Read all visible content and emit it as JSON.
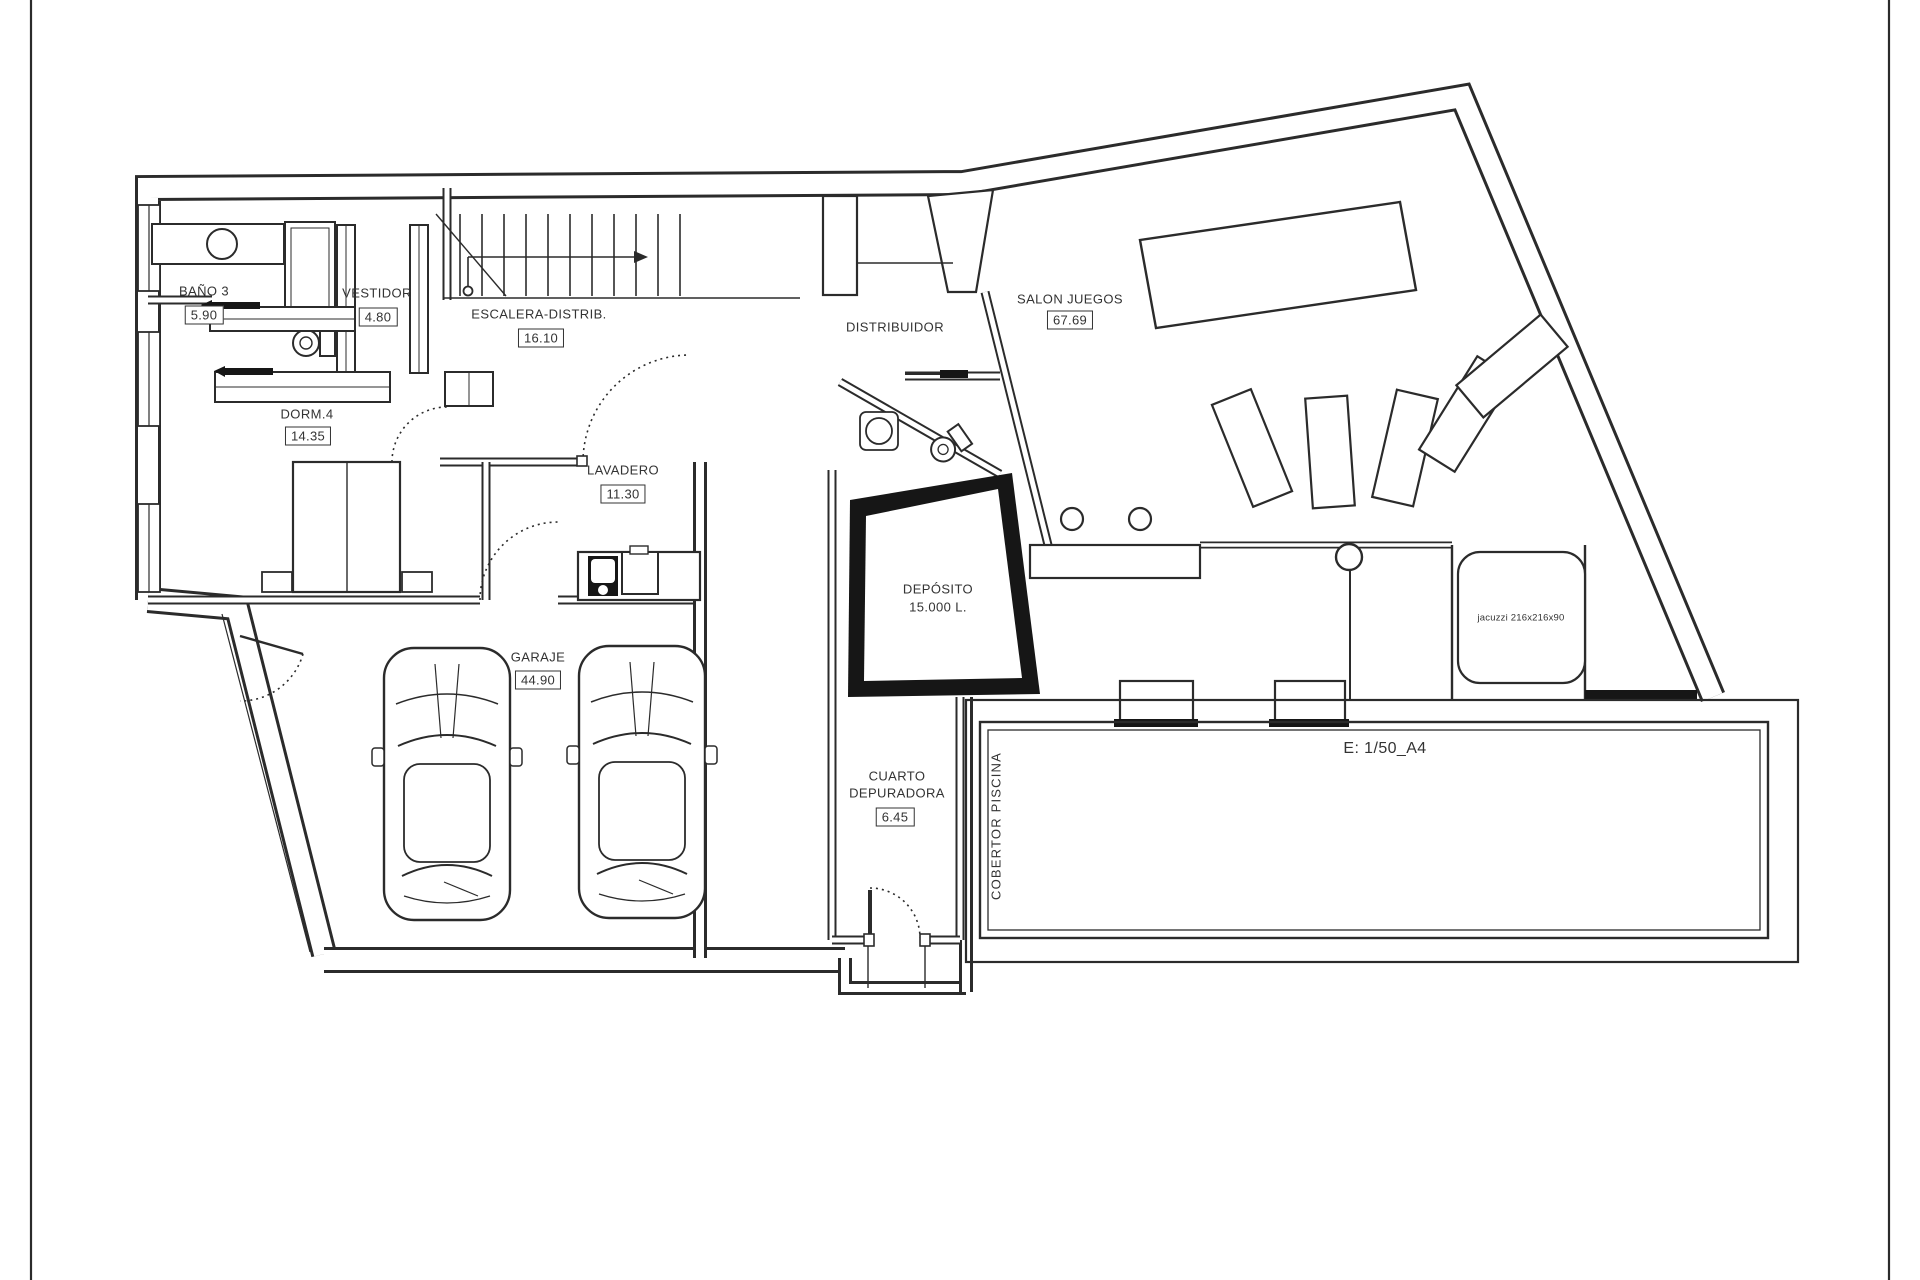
{
  "plan": {
    "rooms": [
      {
        "name": "BAÑO 3",
        "area": "5.90"
      },
      {
        "name": "VESTIDOR",
        "area": "4.80"
      },
      {
        "name": "ESCALERA-DISTRIB.",
        "area": "16.10"
      },
      {
        "name": "DORM.4",
        "area": "14.35"
      },
      {
        "name": "LAVADERO",
        "area": "11.30"
      },
      {
        "name": "DISTRIBUIDOR",
        "area": ""
      },
      {
        "name": "SALON JUEGOS",
        "area": "67.69"
      },
      {
        "name": "GARAJE",
        "area": "44.90"
      },
      {
        "name": "CUARTO DEPURADORA",
        "name_line1": "CUARTO",
        "name_line2": "DEPURADORA",
        "area": "6.45"
      },
      {
        "name": "DEPÓSITO",
        "capacity": "15.000 L."
      }
    ],
    "annotations": {
      "pool_cover": "COBERTOR PISCINA",
      "jacuzzi": "jacuzzi 216x216x90",
      "scale": "E: 1/50_A4"
    }
  }
}
